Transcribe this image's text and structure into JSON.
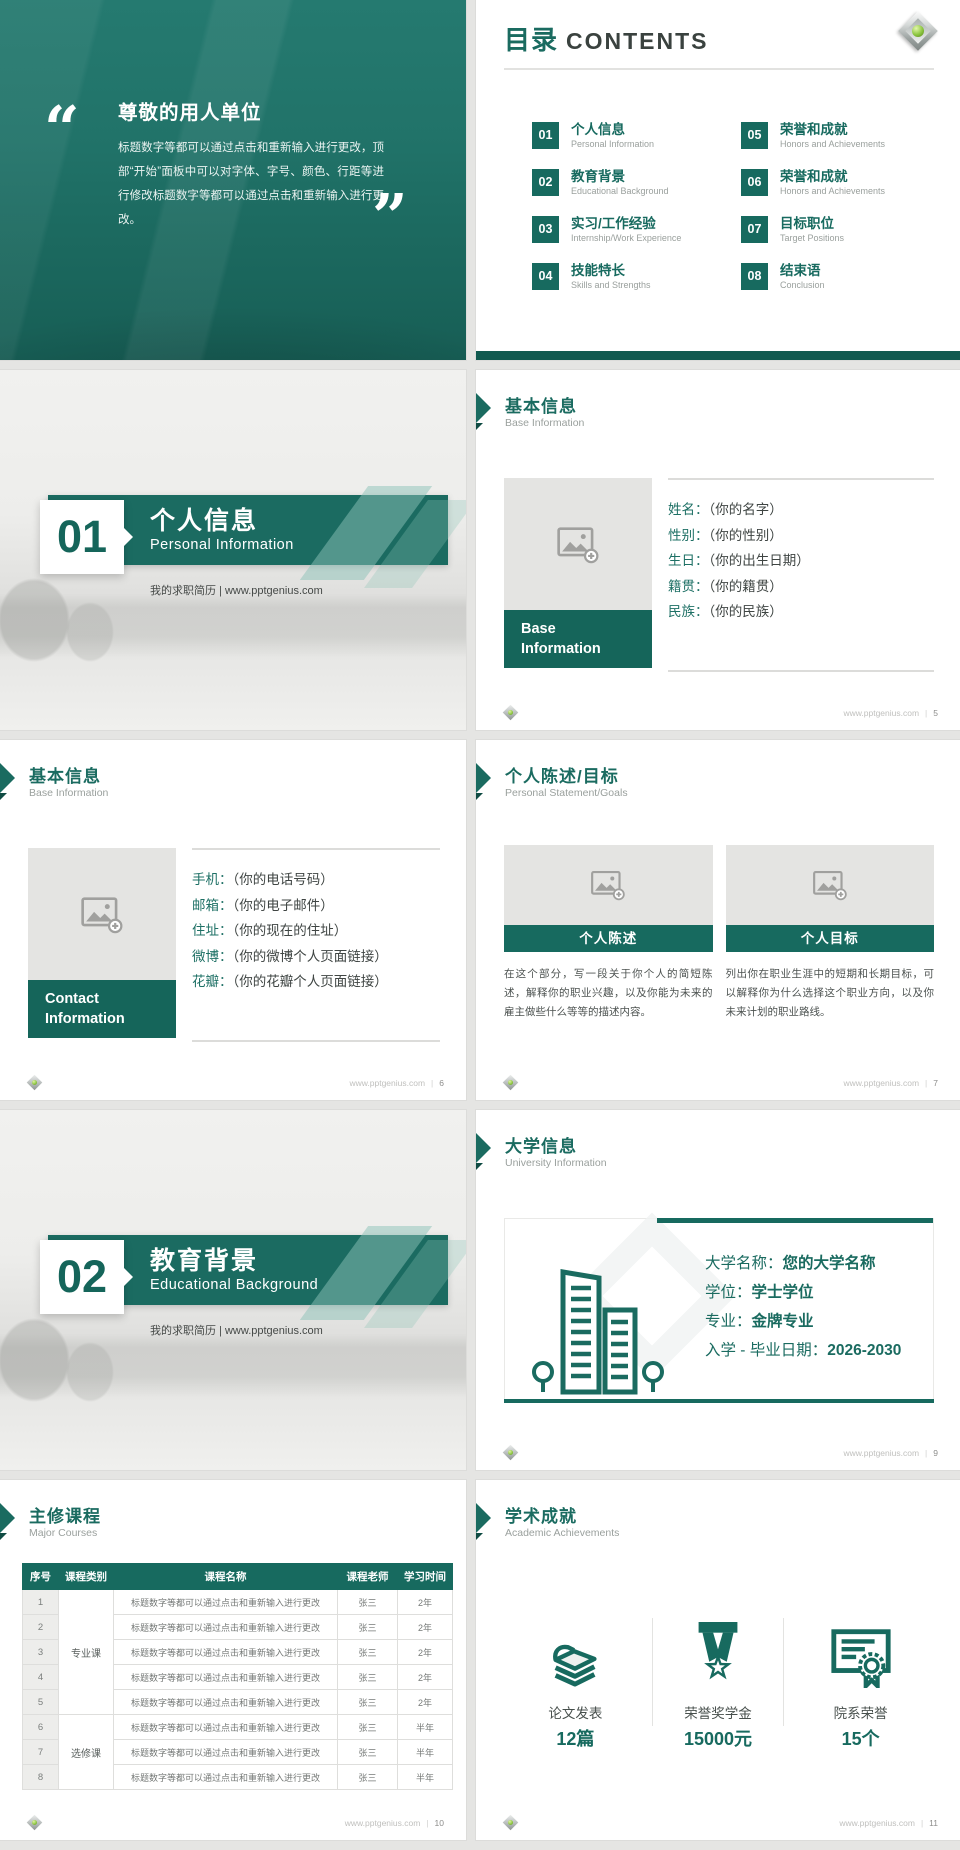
{
  "brand": {
    "site": "www.pptgenius.com",
    "sep": "|",
    "teal": "#176A5F",
    "teal_dark": "#115A50"
  },
  "quote": {
    "open": "“",
    "close": "”",
    "title": "尊敬的用人单位",
    "body": "标题数字等都可以通过点击和重新输入进行更改，顶部“开始”面板中可以对字体、字号、颜色、行距等进行修改标题数字等都可以通过点击和重新输入进行更改。"
  },
  "contents": {
    "title_zh": "目录",
    "title_en": "CONTENTS",
    "items": [
      {
        "num": "01",
        "zh": "个人信息",
        "en": "Personal Information"
      },
      {
        "num": "02",
        "zh": "教育背景",
        "en": "Educational Background"
      },
      {
        "num": "03",
        "zh": "实习/工作经验",
        "en": "Internship/Work Experience"
      },
      {
        "num": "04",
        "zh": "技能特长",
        "en": "Skills and Strengths"
      },
      {
        "num": "05",
        "zh": "荣誉和成就",
        "en": "Honors and Achievements"
      },
      {
        "num": "06",
        "zh": "荣誉和成就",
        "en": "Honors and Achievements"
      },
      {
        "num": "07",
        "zh": "目标职位",
        "en": "Target Positions"
      },
      {
        "num": "08",
        "zh": "结束语",
        "en": "Conclusion"
      }
    ]
  },
  "sections": [
    {
      "num": "01",
      "zh": "个人信息",
      "en": "Personal Information",
      "tagline": "我的求职简历 | www.pptgenius.com"
    },
    {
      "num": "02",
      "zh": "教育背景",
      "en": "Educational Background",
      "tagline": "我的求职简历 | www.pptgenius.com"
    }
  ],
  "base": {
    "header_zh": "基本信息",
    "header_en": "Base Information",
    "band": "Base Information",
    "fields": [
      {
        "label": "姓名：",
        "value": "（你的名字）"
      },
      {
        "label": "性别：",
        "value": "（你的性别）"
      },
      {
        "label": "生日：",
        "value": "（你的出生日期）"
      },
      {
        "label": "籍贯：",
        "value": "（你的籍贯）"
      },
      {
        "label": "民族：",
        "value": "（你的民族）"
      }
    ],
    "page": "5"
  },
  "contact": {
    "header_zh": "基本信息",
    "header_en": "Base Information",
    "band": "Contact Information",
    "fields": [
      {
        "label": "手机：",
        "value": "（你的电话号码）"
      },
      {
        "label": "邮箱：",
        "value": "（你的电子邮件）"
      },
      {
        "label": "住址：",
        "value": "（你的现在的住址）"
      },
      {
        "label": "微博：",
        "value": "（你的微博个人页面链接）"
      },
      {
        "label": "花瓣：",
        "value": "（你的花瓣个人页面链接）"
      }
    ],
    "page": "6"
  },
  "statement": {
    "header_zh": "个人陈述/目标",
    "header_en": "Personal Statement/Goals",
    "cards": [
      {
        "band": "个人陈述",
        "text": "在这个部分，写一段关于你个人的简短陈述，解释你的职业兴趣，以及你能为未来的雇主做些什么等等的描述内容。"
      },
      {
        "band": "个人目标",
        "text": "列出你在职业生涯中的短期和长期目标，可以解释你为什么选择这个职业方向，以及你未来计划的职业路线。"
      }
    ],
    "page": "7"
  },
  "university": {
    "header_zh": "大学信息",
    "header_en": "University Information",
    "fields": [
      {
        "label": "大学名称：",
        "value": "您的大学名称"
      },
      {
        "label": "学位：",
        "value": "学士学位"
      },
      {
        "label": "专业：",
        "value": "金牌专业"
      },
      {
        "label": "入学 - 毕业日期：",
        "value": "2026-2030"
      }
    ],
    "page": "9"
  },
  "courses": {
    "header_zh": "主修课程",
    "header_en": "Major Courses",
    "columns": [
      "序号",
      "课程类别",
      "课程名称",
      "课程老师",
      "学习时间"
    ],
    "groups": [
      {
        "label": "专业课"
      },
      {
        "label": "选修课"
      }
    ],
    "rows": [
      {
        "no": "1",
        "name": "标题数字等都可以通过点击和重新输入进行更改",
        "teacher": "张三",
        "time": "2年"
      },
      {
        "no": "2",
        "name": "标题数字等都可以通过点击和重新输入进行更改",
        "teacher": "张三",
        "time": "2年"
      },
      {
        "no": "3",
        "name": "标题数字等都可以通过点击和重新输入进行更改",
        "teacher": "张三",
        "time": "2年"
      },
      {
        "no": "4",
        "name": "标题数字等都可以通过点击和重新输入进行更改",
        "teacher": "张三",
        "time": "2年"
      },
      {
        "no": "5",
        "name": "标题数字等都可以通过点击和重新输入进行更改",
        "teacher": "张三",
        "time": "2年"
      },
      {
        "no": "6",
        "name": "标题数字等都可以通过点击和重新输入进行更改",
        "teacher": "张三",
        "time": "半年"
      },
      {
        "no": "7",
        "name": "标题数字等都可以通过点击和重新输入进行更改",
        "teacher": "张三",
        "time": "半年"
      },
      {
        "no": "8",
        "name": "标题数字等都可以通过点击和重新输入进行更改",
        "teacher": "张三",
        "time": "半年"
      }
    ],
    "page": "10"
  },
  "achievements": {
    "header_zh": "学术成就",
    "header_en": "Academic Achievements",
    "stats": [
      {
        "label": "论文发表",
        "value": "12篇"
      },
      {
        "label": "荣誉奖学金",
        "value": "15000元"
      },
      {
        "label": "院系荣誉",
        "value": "15个"
      }
    ],
    "page": "11"
  }
}
